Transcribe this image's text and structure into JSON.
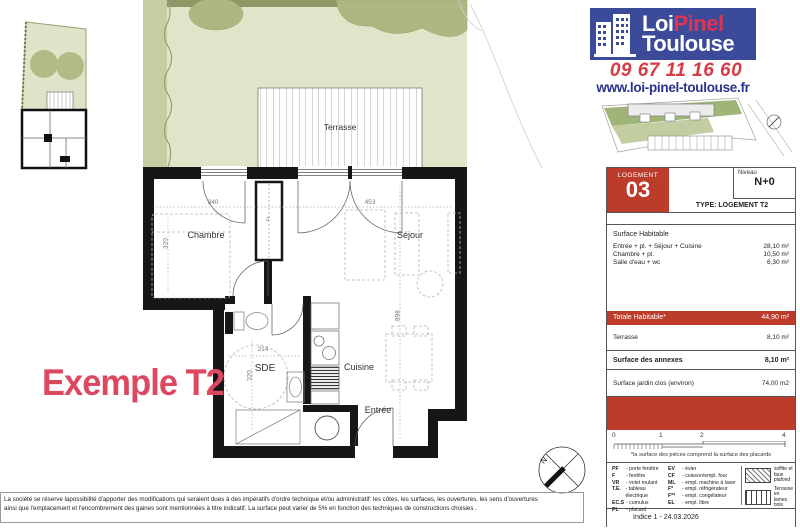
{
  "colors": {
    "brand_blue": "#3c4a9a",
    "brand_red": "#e0334e",
    "phone_red": "#d63a45",
    "website_blue": "#27338c",
    "brick_red": "#bd3b2a",
    "example_pink": "#dc4860",
    "garden_light": "#e0e4c9",
    "garden_dark": "#aeb682"
  },
  "header": {
    "logo_line1_a": "Loi",
    "logo_line1_b": "Pinel",
    "logo_line2": "Toulouse",
    "phone": "09 67 11 16 60",
    "website": "www.loi-pinel-toulouse.fr"
  },
  "plan": {
    "example_label": "Exemple T2",
    "labels": {
      "terrasse": "Terrasse",
      "chambre": "Chambre",
      "sejour": "Séjour",
      "sde": "SDE",
      "cuisine": "Cuisine",
      "entree": "Entrée",
      "placard": "PL"
    },
    "dims": {
      "chambre_w": "340",
      "sejour_w": "453",
      "chambre_h": "320",
      "sde_w": "214",
      "sde_h": "320",
      "sejour_h": "898"
    },
    "compass_n": "N"
  },
  "card": {
    "logement_label": "LOGEMENT",
    "logement_no": "03",
    "niveau_label": "Niveau",
    "niveau_value": "N+0",
    "type_line": "TYPE:  LOGEMENT T2",
    "surface_title": "Surface Habitable",
    "surface_rows": [
      {
        "label": "Entrée + pl. + Séjour + Cuisine",
        "value": "28,10 m²"
      },
      {
        "label": "Chambre + pl.",
        "value": "10,50 m²"
      },
      {
        "label": "Salle d'eau + wc",
        "value": "6,30 m²"
      }
    ],
    "totale_label": "Totale Habitable*",
    "totale_value": "44,90 m²",
    "terrasse_label": "Terrasse",
    "terrasse_value": "8,10 m²",
    "annexes_label": "Surface des annexes",
    "annexes_value": "8,10 m²",
    "jardin_label": "Surface jardin clos (environ)",
    "jardin_value": "74,00 m2",
    "scale_ticks": [
      "0",
      "1",
      "2",
      "4"
    ],
    "footnote": "*la surface des pièces comprend la surface des placards",
    "legend_col1": [
      {
        "abbr": "PF",
        "label": "- porte fenêtre"
      },
      {
        "abbr": "F",
        "label": "- fenêtre"
      },
      {
        "abbr": "VR",
        "label": "- volet roulant"
      },
      {
        "abbr": "T.E.",
        "label": "- tableau électrique"
      },
      {
        "abbr": "EC.S",
        "label": "- cumulus"
      },
      {
        "abbr": "PL",
        "label": "- placard"
      }
    ],
    "legend_col2": [
      {
        "abbr": "EV",
        "label": "- évier"
      },
      {
        "abbr": "CF",
        "label": "- cuisson/empl. four"
      },
      {
        "abbr": "ML",
        "label": "- empl. machine à laver"
      },
      {
        "abbr": "F*",
        "label": "- empl. réfrigérateur"
      },
      {
        "abbr": "F**",
        "label": "- empl. congélateur"
      },
      {
        "abbr": "EL",
        "label": "- empl. libre"
      }
    ],
    "legend_swatches": [
      {
        "label": "soffite et faux plafond"
      },
      {
        "label": "Terrasse en lames bois"
      }
    ],
    "indice": "Indice 1 - 24.03.2026"
  },
  "footer": {
    "line1": "La société se réserve lapossibilité d'apporter des modifications qui seraient dues à des impératifs d'ordre technique et/ou administratif: les côtes, les surfaces, les ouvertures, les sens d'ouvertures",
    "line2": "ainsi que l'emplacement et l'encombrement des gaines sont mentionnées à titre indicatif. La surface peut varier de 5% en fonction des techniques de constructions choisies ."
  }
}
